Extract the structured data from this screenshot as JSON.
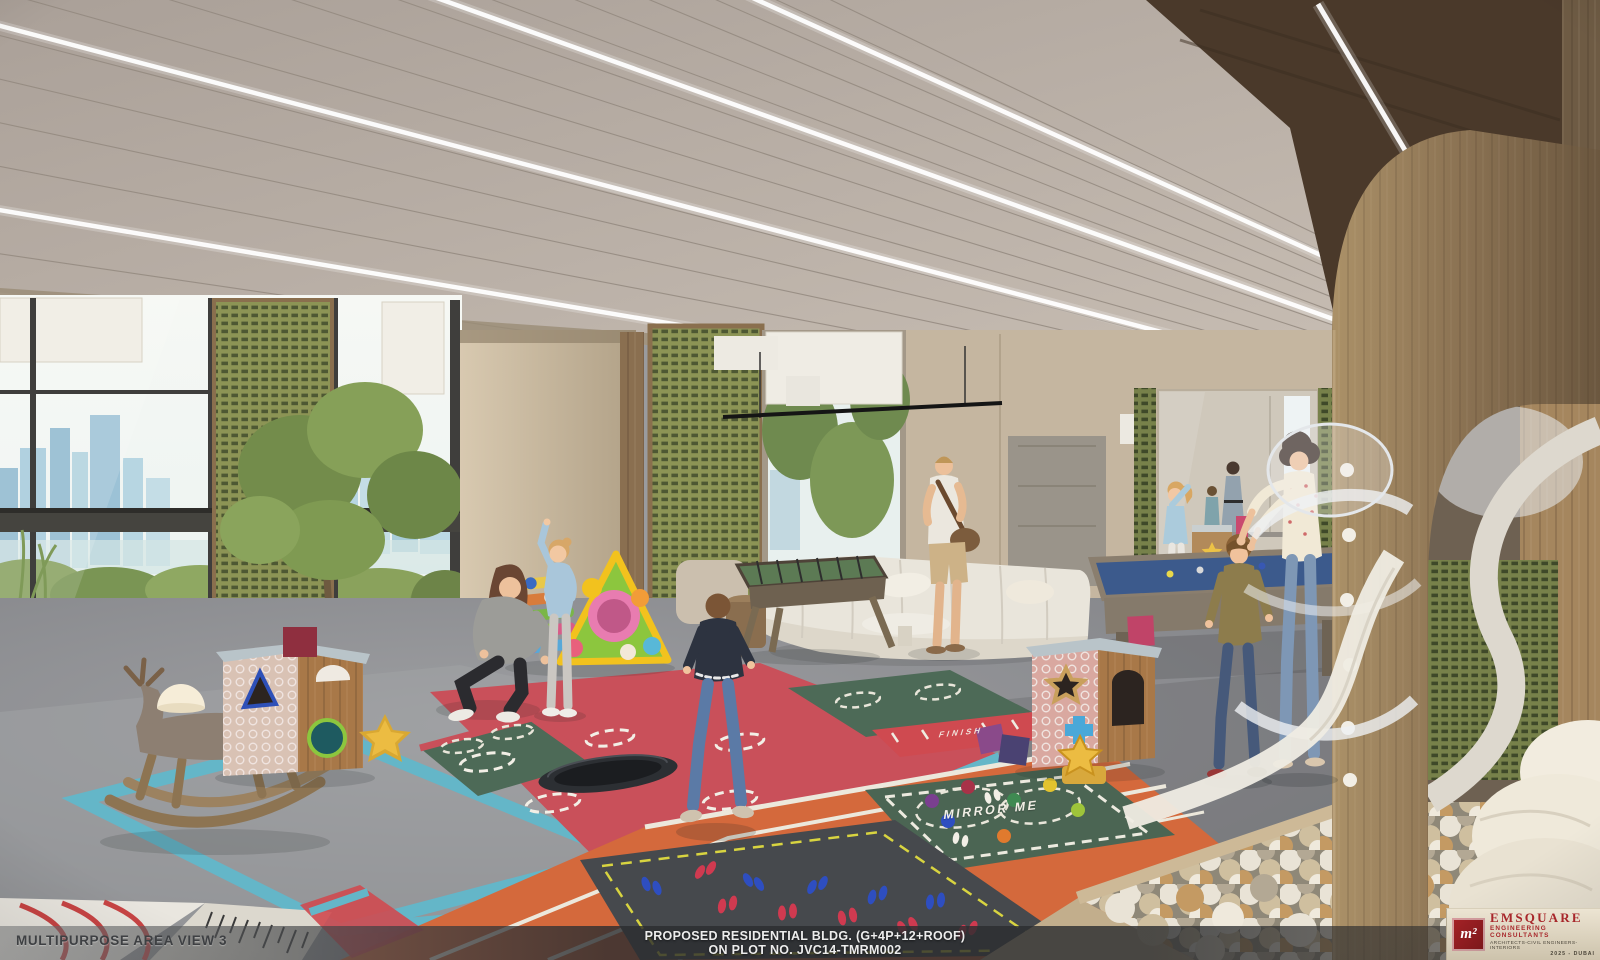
{
  "caption_bar": {
    "view_label": "MULTIPURPOSE AREA VIEW 3",
    "project_line1": "PROPOSED RESIDENTIAL BLDG. (G+4P+12+ROOF)",
    "project_line2": "ON PLOT NO. JVC14-TMRM002"
  },
  "logo": {
    "mark": "m²",
    "company": "EMSQUARE",
    "tagline": "ENGINEERING CONSULTANTS",
    "disciplines": "ARCHITECTS-CIVIL ENGINEERS-INTERIORS",
    "year_city": "2025 - DUBAI"
  },
  "floor_graphics": {
    "mirror_me": "MIRROR ME",
    "finish": "FINISH"
  },
  "palette": {
    "brand_red": "#a8272b",
    "mat_red": "#c9505a",
    "mat_orange": "#d4693c",
    "mat_green": "#4d6a57",
    "mat_teal": "#64b6c8",
    "mat_dark": "#46494d",
    "lattice_olive": "#8a9152",
    "ceiling_taupe": "#b5aba2",
    "wood_tan": "#a18a66",
    "pool_felt_blue": "#3c5a8c"
  },
  "scene": {
    "description": "Architectural rendering of an indoor children's multipurpose play area: colorful play mats with trampoline and running track, ball pit with spiral slide, pool table, lounge seating and floor-to-ceiling windows over a city skyline."
  }
}
